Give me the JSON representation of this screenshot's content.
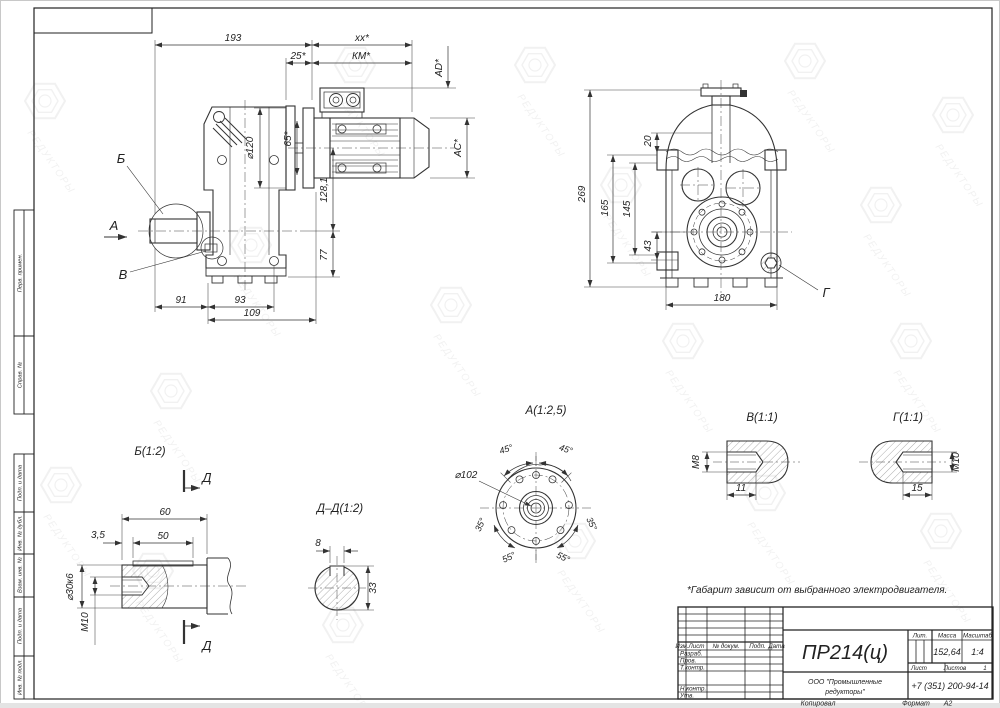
{
  "margin_fields": [
    "Перв. примен.",
    "Справ. №",
    "Подп. и дата",
    "Инв. № дубл.",
    "Взам. инв. №",
    "Подп. и дата",
    "Инв. № подл."
  ],
  "watermark": {
    "text": "РЕДУКТОРЫ"
  },
  "note": "*Габарит зависит от выбранного электродвигателя.",
  "views": {
    "side": {
      "dims": {
        "total_length": "193",
        "motor_length": "xx*",
        "adapter_len": "25*",
        "km": "КМ*",
        "ad": "AD*",
        "ac": "AC*",
        "pilot": "65*",
        "flange_dia": "⌀120",
        "axis_offset": "128,1",
        "base_height": "77",
        "left_len": "91",
        "base_len": "93",
        "base_full": "109"
      },
      "labels": {
        "detail_b": "Б",
        "view_a": "А",
        "detail_v": "В"
      }
    },
    "front": {
      "dims": {
        "height_total": "269",
        "h165": "165",
        "h145": "145",
        "h43": "43",
        "h20": "20",
        "width": "180"
      },
      "labels": {
        "detail_g": "Г"
      }
    },
    "detail_b": {
      "title": "Б(1:2)",
      "dims": {
        "len": "60",
        "key_len": "50",
        "key_offset": "3,5",
        "shaft_dia": "⌀30к6",
        "thread": "М10"
      },
      "section_label": "Д"
    },
    "section_dd": {
      "title": "Д–Д(1:2)",
      "dims": {
        "key_width": "8",
        "height": "33"
      }
    },
    "detail_a": {
      "title": "А(1:2,5)",
      "dims": {
        "dia": "⌀102",
        "a45": "45°",
        "a35": "35°",
        "a55": "55°"
      }
    },
    "detail_v": {
      "title": "В(1:1)",
      "dims": {
        "thread": "М8",
        "depth": "11"
      }
    },
    "detail_g": {
      "title": "Г(1:1)",
      "dims": {
        "thread": "М10",
        "depth": "15"
      }
    }
  },
  "title_block": {
    "doc_number": "ПР214(ц)",
    "company_line1": "ООО \"Промышленные",
    "company_line2": "редукторы\"",
    "phone": "+7 (351) 200-94-14",
    "mass": "152,64",
    "scale": "1:4",
    "sheets_count": "1",
    "labels": {
      "izm": "Изм.",
      "list": "Лист",
      "doc": "№ докум.",
      "podp": "Подп.",
      "data": "Дата",
      "razrab": "Разраб.",
      "prov": "Пров.",
      "tkontr": "Т.контр.",
      "nkontr": "Н.контр.",
      "utv": "Утв.",
      "lit": "Лит.",
      "massa": "Масса",
      "scale": "Масштаб",
      "sheet": "Лист",
      "sheets": "Листов",
      "copied": "Копировал",
      "format": "Формат",
      "format_value": "А2"
    }
  }
}
